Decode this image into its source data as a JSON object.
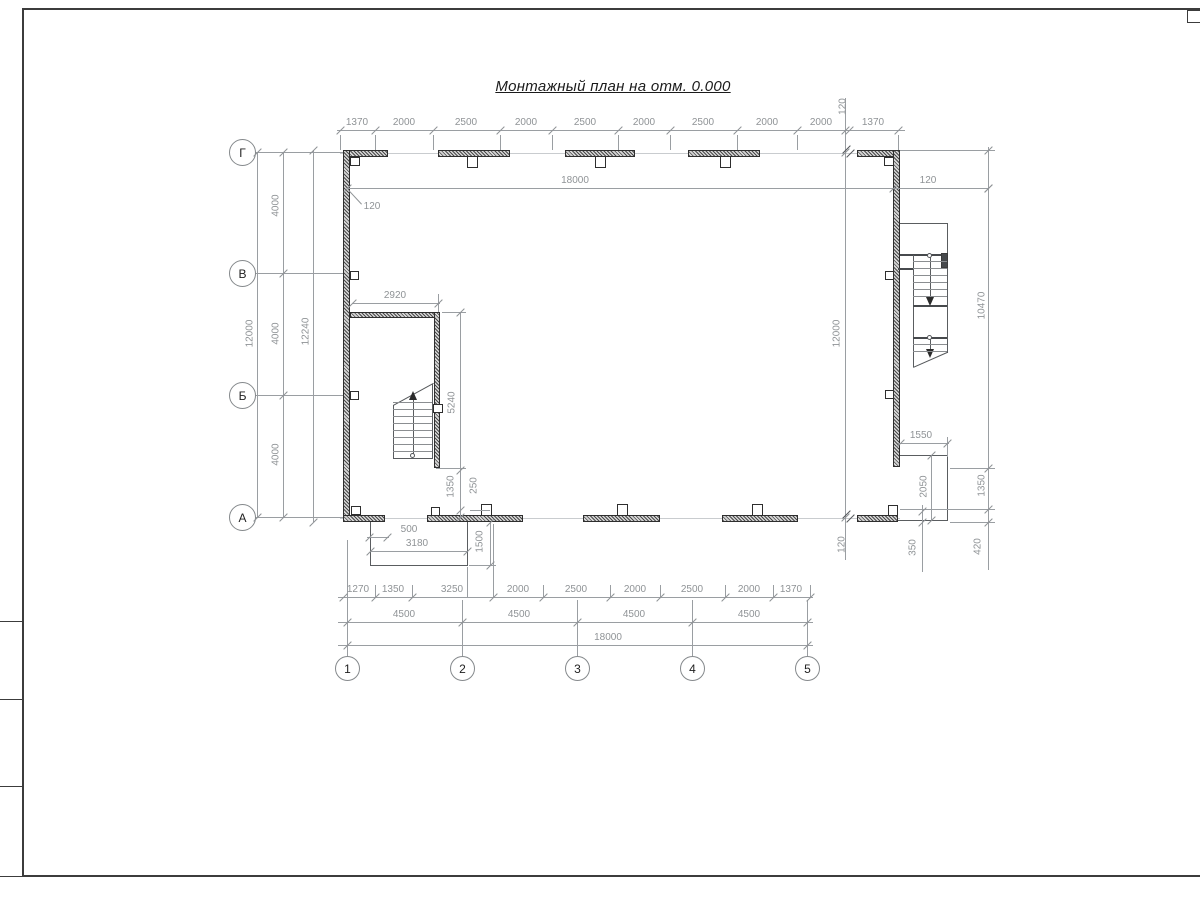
{
  "title": "Монтажный план на отм. 0.000",
  "top_chain": [
    "1370",
    "2000",
    "2500",
    "2000",
    "2500",
    "2000",
    "2500",
    "2000",
    "2000",
    "120",
    "1370"
  ],
  "inner": {
    "w18000": "18000",
    "left120": "120",
    "right120": "120"
  },
  "left_col": {
    "seg_gv": "4000",
    "seg_vb": "4000",
    "seg_ba": "4000",
    "total": "12000",
    "overall": "12240"
  },
  "right_col": {
    "v12000": "12000",
    "bot120": "120",
    "v10470": "10470",
    "v1350": "1350",
    "v420": "420"
  },
  "stair_left_dims": {
    "w2920": "2920",
    "h5240": "5240",
    "h1350": "1350",
    "h250": "250"
  },
  "porch_left_dims": {
    "w500": "500",
    "w3180": "3180",
    "h1500": "1500"
  },
  "porch_right_dims": {
    "w1550": "1550",
    "h2050": "2050",
    "h350": "350"
  },
  "bottom_chain1": [
    "1270",
    "1350",
    "3250",
    "2000",
    "2500",
    "2000",
    "2500",
    "2000",
    "1370"
  ],
  "bottom_chain2": [
    "4500",
    "4500",
    "4500",
    "4500"
  ],
  "bottom_total": "18000",
  "axes_h": [
    "1",
    "2",
    "3",
    "4",
    "5"
  ],
  "axes_v": [
    "Г",
    "В",
    "Б",
    "А"
  ]
}
